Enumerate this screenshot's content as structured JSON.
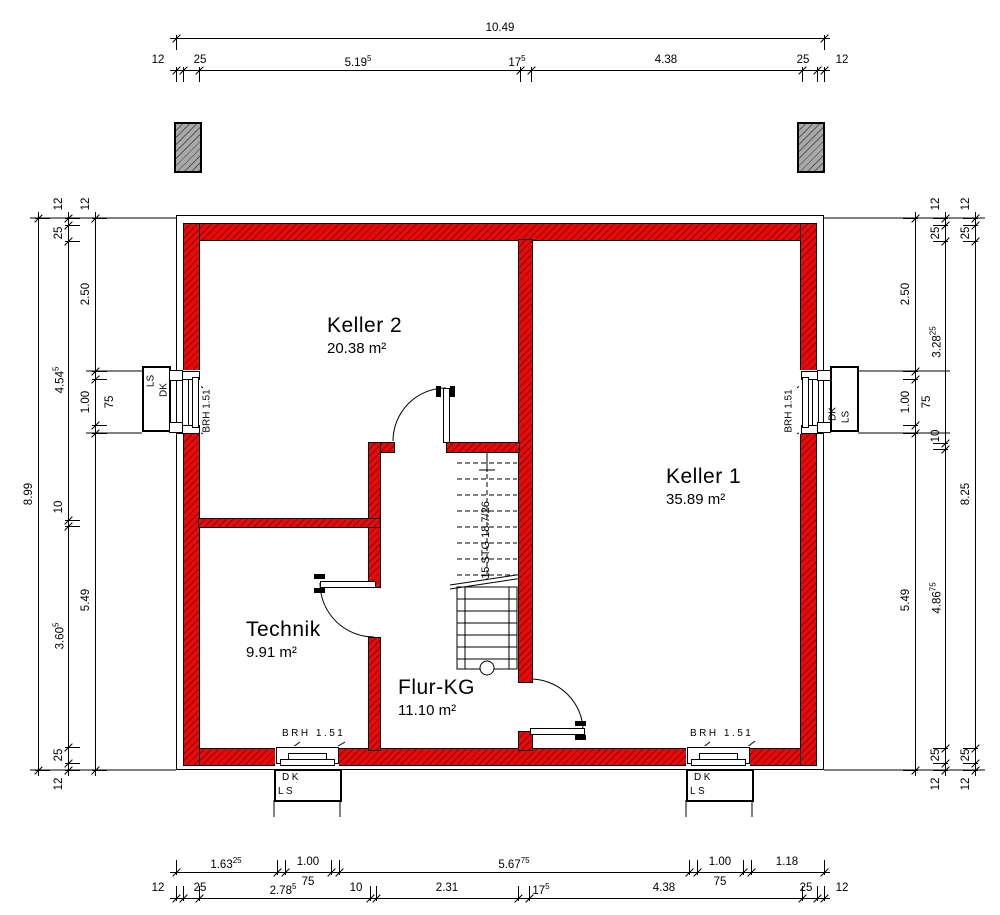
{
  "rooms": [
    {
      "name": "Keller 2",
      "area": "20.38 m²"
    },
    {
      "name": "Keller 1",
      "area": "35.89 m²"
    },
    {
      "name": "Technik",
      "area": "9.91 m²"
    },
    {
      "name": "Flur-KG",
      "area": "11.10 m²"
    }
  ],
  "stair": {
    "label": "15 STG 18.7/26"
  },
  "labels": {
    "brh": "BRH 1.51",
    "dk": "DK",
    "ls": "LS"
  },
  "colors": {
    "wall_red": "#e60b0b",
    "wall_hatch": "#8c0404",
    "pier_gray": "#a8a8a8",
    "line": "#000000"
  },
  "dims": {
    "h": [
      {
        "name": "top-total",
        "y": 38,
        "side": "below",
        "ticks": [
          176,
          824
        ],
        "labels": [
          {
            "t": "10.49",
            "x": 500
          }
        ]
      },
      {
        "name": "top-detail",
        "y": 70,
        "side": "below",
        "ticks": [
          176,
          183,
          199,
          520,
          531,
          802,
          817,
          824
        ],
        "labels": [
          {
            "t": "12",
            "x": 158
          },
          {
            "t": "25",
            "x": 200
          },
          {
            "t": "5.19",
            "s": "5",
            "x": 358
          },
          {
            "t": "17",
            "s": "5",
            "x": 517
          },
          {
            "t": "4.38",
            "x": 666
          },
          {
            "t": "25",
            "x": 803
          },
          {
            "t": "12",
            "x": 842
          }
        ]
      },
      {
        "name": "bottom-upper",
        "y": 872,
        "side": "above",
        "ticks": [
          176,
          277,
          285,
          331,
          339,
          689,
          697,
          743,
          751,
          824
        ],
        "labels": [
          {
            "t": "1.63",
            "s": "25",
            "x": 226
          },
          {
            "t": "1.00",
            "x": 308
          },
          {
            "t": "5.67",
            "s": "75",
            "x": 514
          },
          {
            "t": "1.00",
            "x": 720
          },
          {
            "t": "1.18",
            "x": 787
          }
        ],
        "sub": [
          {
            "t": "75",
            "x": 308,
            "y": 876
          },
          {
            "t": "75",
            "x": 720,
            "y": 876
          }
        ]
      },
      {
        "name": "bottom-lower",
        "y": 898,
        "side": "above",
        "ticks": [
          176,
          183,
          199,
          370,
          376,
          518,
          529,
          802,
          817,
          824
        ],
        "labels": [
          {
            "t": "12",
            "x": 158
          },
          {
            "t": "25",
            "x": 200
          },
          {
            "t": "2.78",
            "s": "5",
            "x": 283
          },
          {
            "t": "10",
            "x": 356
          },
          {
            "t": "2.31",
            "x": 447
          },
          {
            "t": "17",
            "s": "5",
            "x": 541
          },
          {
            "t": "4.38",
            "x": 664
          },
          {
            "t": "25",
            "x": 806
          },
          {
            "t": "12",
            "x": 842
          }
        ]
      }
    ],
    "v": [
      {
        "name": "left-total",
        "x": 38,
        "side": "right",
        "ticks": [
          218,
          770
        ],
        "labels": [
          {
            "t": "8.99",
            "y": 494
          }
        ]
      },
      {
        "name": "left-mid",
        "x": 68,
        "side": "right",
        "ticks": [
          218,
          225,
          241,
          520,
          526,
          747,
          763,
          770
        ],
        "labels": [
          {
            "t": "12",
            "y": 204
          },
          {
            "t": "25",
            "y": 233
          },
          {
            "t": "4.54",
            "s": "5",
            "y": 380
          },
          {
            "t": "10",
            "y": 507
          },
          {
            "t": "3.60",
            "s": "5",
            "y": 636
          },
          {
            "t": "25",
            "y": 755
          },
          {
            "t": "12",
            "y": 784
          }
        ]
      },
      {
        "name": "left-inner",
        "x": 95,
        "side": "right",
        "ticks": [
          218,
          371,
          379,
          425,
          433,
          770
        ],
        "labels": [
          {
            "t": "12",
            "y": 204
          },
          {
            "t": "2.50",
            "y": 294
          },
          {
            "t": "1.00",
            "y": 402
          },
          {
            "t": "5.49",
            "y": 600
          }
        ],
        "sub": [
          {
            "t": "75",
            "x": 110,
            "y": 402
          }
        ]
      },
      {
        "name": "right-inner",
        "x": 915,
        "side": "left",
        "ticks": [
          218,
          371,
          379,
          425,
          433,
          770
        ],
        "labels": [
          {
            "t": "2.50",
            "y": 294
          },
          {
            "t": "1.00",
            "y": 402
          },
          {
            "t": "5.49",
            "y": 600
          }
        ],
        "sub": [
          {
            "t": "75",
            "x": 927,
            "y": 402
          }
        ]
      },
      {
        "name": "right-mid",
        "x": 945,
        "side": "left",
        "ticks": [
          218,
          225,
          241,
          443,
          449,
          748,
          763,
          770
        ],
        "labels": [
          {
            "t": "12",
            "y": 204
          },
          {
            "t": "25",
            "y": 233
          },
          {
            "t": "3.28",
            "s": "25",
            "y": 342
          },
          {
            "t": "10",
            "y": 436
          },
          {
            "t": "4.86",
            "s": "75",
            "y": 598
          },
          {
            "t": "25",
            "y": 755
          },
          {
            "t": "12",
            "y": 784
          }
        ]
      },
      {
        "name": "right-outer",
        "x": 975,
        "side": "left",
        "ticks": [
          218,
          225,
          241,
          748,
          763,
          770
        ],
        "labels": [
          {
            "t": "12",
            "y": 204
          },
          {
            "t": "25",
            "y": 233
          },
          {
            "t": "8.25",
            "y": 494
          },
          {
            "t": "25",
            "y": 755
          },
          {
            "t": "12",
            "y": 784
          }
        ]
      }
    ]
  }
}
